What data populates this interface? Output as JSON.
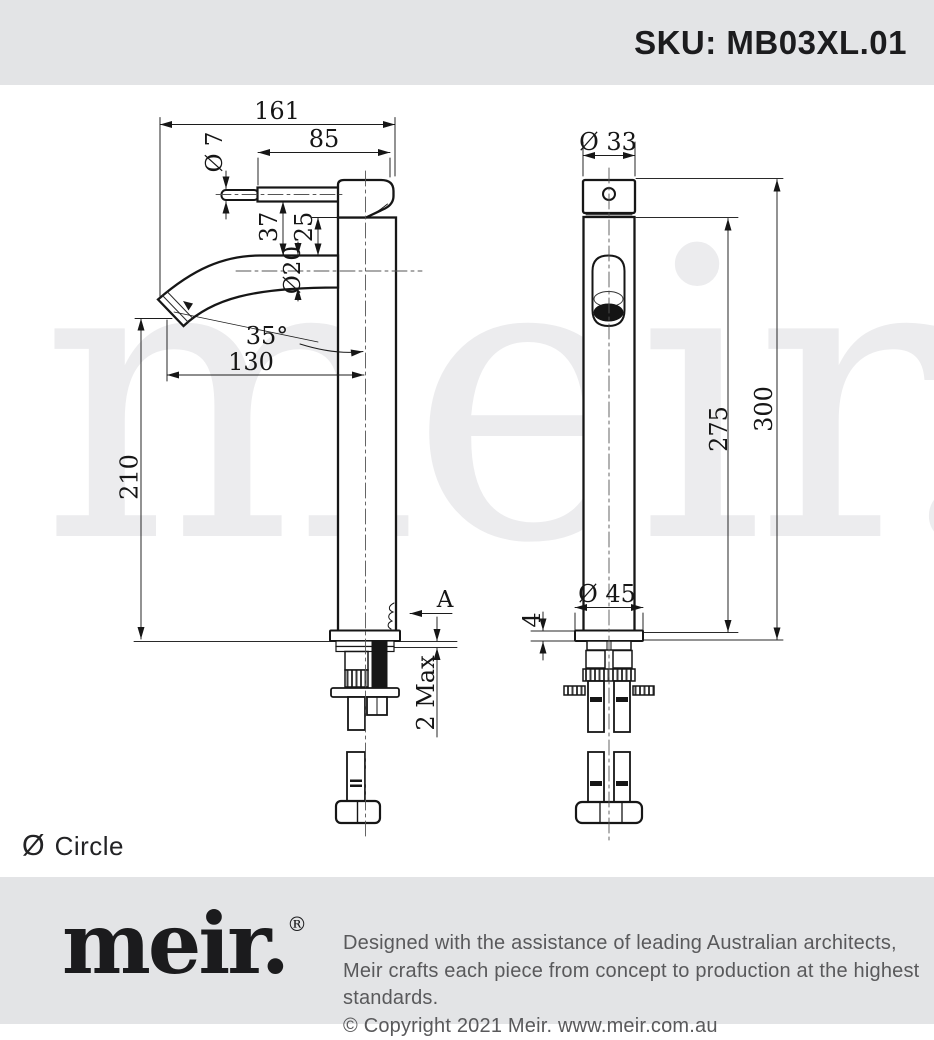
{
  "header": {
    "sku": "SKU: MB03XL.01"
  },
  "watermark": "meir.",
  "drawing": {
    "side_view": {
      "d161": "161",
      "d85": "85",
      "d7": "Ø 7",
      "d37": "37",
      "d25": "25",
      "d20": "Ø20",
      "d35": "35°",
      "d130": "130",
      "d210": "210",
      "dA": "A",
      "d2max": "2 Max"
    },
    "front_view": {
      "d33": "Ø 33",
      "d275": "275",
      "d300": "300",
      "d45": "Ø 45",
      "d4": "4"
    }
  },
  "legend": {
    "symbol": "Ø",
    "label": "Circle"
  },
  "footer": {
    "logo": "meir.",
    "registered": "®",
    "line1": "Designed with the assistance of leading Australian architects,",
    "line2": "Meir crafts each piece from concept to production at the highest standards.",
    "line3": "© Copyright 2021 Meir. www.meir.com.au"
  },
  "colors": {
    "banner": "#e3e4e6",
    "line": "#161616",
    "watermark": "#ececee",
    "footer_text": "#59595b"
  }
}
